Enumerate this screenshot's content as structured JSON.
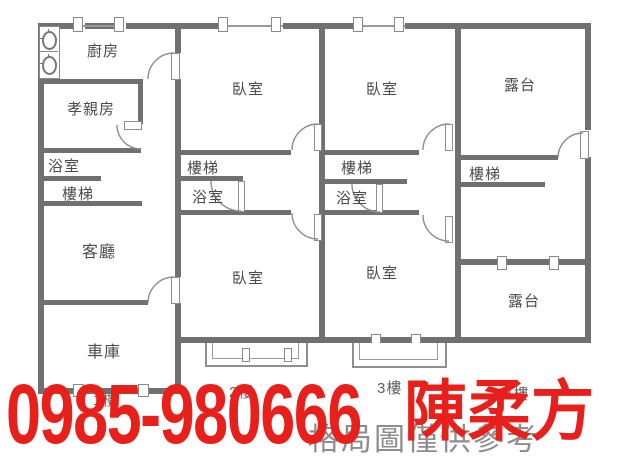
{
  "labels": {
    "kitchen": "廚房",
    "parents_room": "孝親房",
    "bathroom": "浴室",
    "stairs": "樓梯",
    "living_room": "客廳",
    "garage": "車庫",
    "bedroom": "臥室",
    "terrace": "露台"
  },
  "floors": {
    "f1": "1樓",
    "f2": "2樓",
    "f3": "3樓",
    "f4": "4樓"
  },
  "watermark": "格局圖僅供參考",
  "overlay": {
    "phone": "0985-980666",
    "agent_name": "陳柔方",
    "color": "#e7201b"
  },
  "icons": {
    "stove": "gas-stove-burner-icon"
  },
  "colors": {
    "wall": "#707070",
    "room_label": "#4b4b4b",
    "floor_label": "#606060",
    "watermark": "#8d8d8d"
  }
}
